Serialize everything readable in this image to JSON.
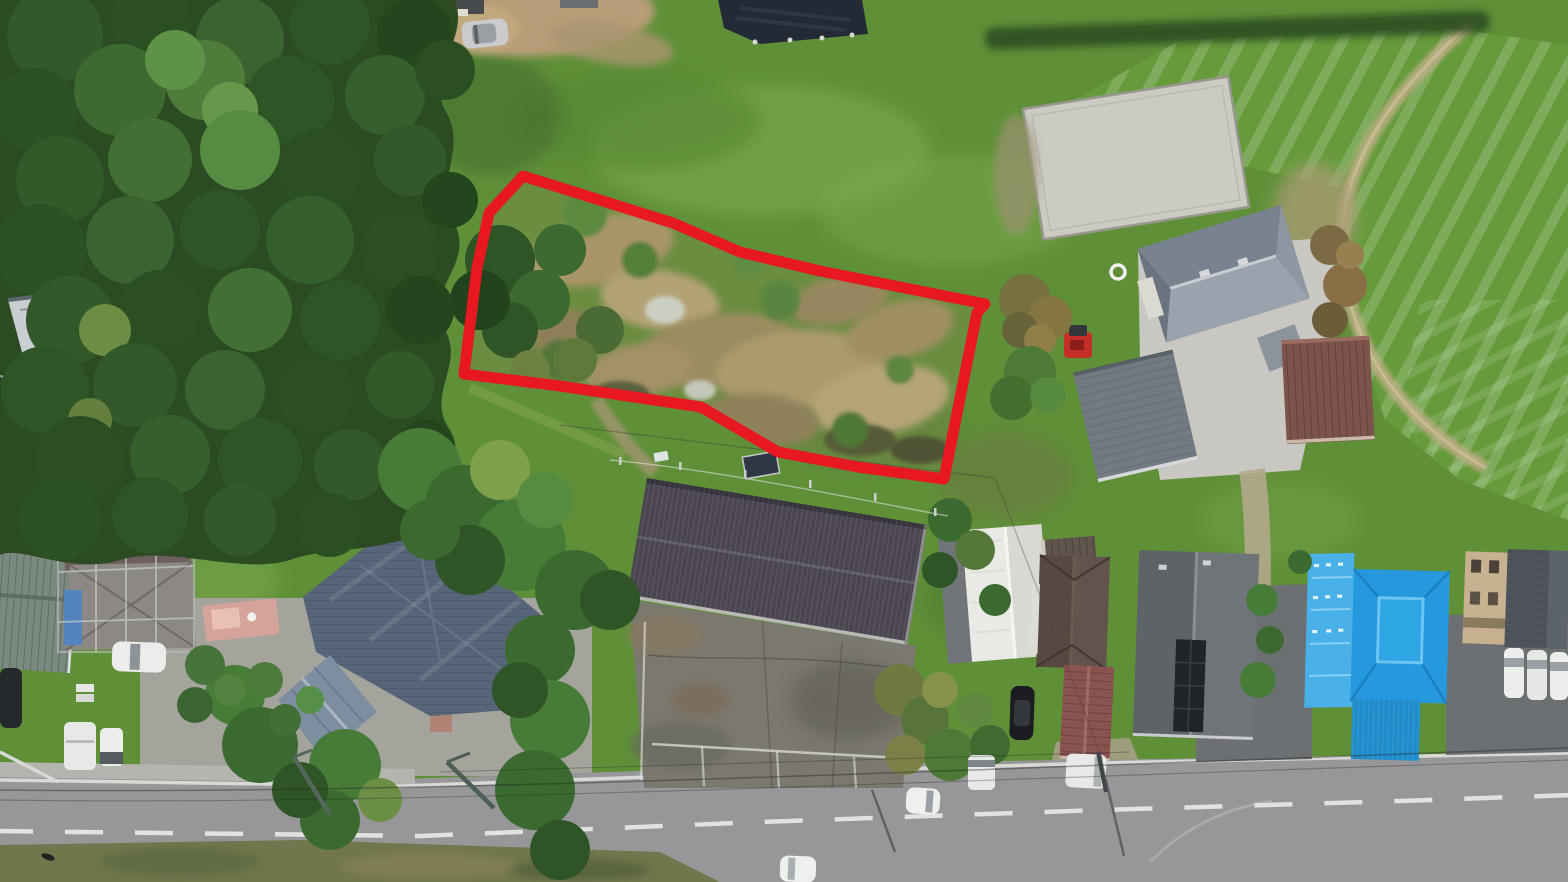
{
  "meta": {
    "type": "aerial-drone-photograph",
    "description": "Overhead drone photo of a rural Japanese roadside neighborhood; a vacant overgrown land parcel is outlined with a thick red boundary annotation.",
    "width_px": 1568,
    "height_px": 882
  },
  "annotation": {
    "name": "property-boundary",
    "shape": "polygon",
    "color": "#e7181f",
    "stroke_width": 11,
    "points_str": "523,176 673,223 740,252 820,271 985,304 977,313 944,479 858,467 778,452 701,407 560,386 464,374 477,268 489,213"
  },
  "palette": {
    "grass": "#5f9038",
    "grass_light": "#7fae53",
    "forest_dark": "#2c4b23",
    "brush_tan": "#a99569",
    "gravel_pad": "#cbcbc4",
    "road_asphalt": "#97979a",
    "parking_asphalt": "#7a786f",
    "warehouse_roof": "#4a4550",
    "slate_blue_roof": "#566579",
    "bright_blue_roof": "#2699de",
    "maroon_roof": "#8a5350",
    "brown_metal_roof": "#7d544c",
    "white_roof": "#e9e9e5",
    "blue_tarp": "#4d84c4",
    "dirt": "#b79c77"
  },
  "scene": {
    "regions": [
      {
        "name": "forest",
        "desc": "dense conifer/broadleaf canopy along left edge",
        "color": "#2c4b23"
      },
      {
        "name": "vacant-parcel-brush",
        "desc": "cleared overgrown lot with dry brown brush inside red boundary",
        "color": "#a99569"
      },
      {
        "name": "striped-field",
        "desc": "mown hay field with curved stripe rows, top right",
        "color": "#659b3b"
      },
      {
        "name": "gravel-pad",
        "desc": "rectangular light gravel pad, upper right",
        "color": "#cbcbc4"
      },
      {
        "name": "black-tarp",
        "desc": "dark weed-control tarp at top center",
        "color": "#232a36"
      },
      {
        "name": "road",
        "desc": "two-lane asphalt road across bottom with white centerline dashes",
        "color": "#97979a"
      },
      {
        "name": "parking-lot",
        "desc": "cracked asphalt lot south of warehouse",
        "color": "#7a786f"
      },
      {
        "name": "dirt-clearing",
        "desc": "bare tan soil clearing at top left",
        "color": "#b79c77"
      }
    ],
    "buildings": [
      {
        "name": "warehouse",
        "roof": "dark corrugated gray",
        "color": "#4a4550"
      },
      {
        "name": "white-roof-building",
        "roof": "white gable",
        "color": "#e9e9e5"
      },
      {
        "name": "renovation-house",
        "roof": "mauve with scaffolding and blue tarps",
        "color": "#6e5e5c"
      },
      {
        "name": "slate-hip-roof-house",
        "roof": "large slate-blue hip roof",
        "color": "#566579"
      },
      {
        "name": "blue-gray-shed",
        "roof": "small light blue-gray gable",
        "color": "#7d8ea0"
      },
      {
        "name": "farmhouse",
        "roof": "gray hip roof, upper right",
        "color": "#79838f"
      },
      {
        "name": "gray-outbuilding",
        "roof": "slate shed roof",
        "color": "#727a84"
      },
      {
        "name": "brown-metal-building",
        "roof": "red-brown standing-seam",
        "color": "#7d544c"
      },
      {
        "name": "dark-brown-house",
        "roof": "dark brown hip",
        "color": "#574842"
      },
      {
        "name": "charcoal-house",
        "roof": "charcoal gable with black solar panel",
        "color": "#5e6368"
      },
      {
        "name": "maroon-shed",
        "roof": "maroon gable",
        "color": "#8a5350"
      },
      {
        "name": "blue-roof-house",
        "roof": "bright blue hip with tarp section",
        "color": "#2699de"
      },
      {
        "name": "tan-building",
        "roof": "tan two-story",
        "color": "#c8b190"
      },
      {
        "name": "corner-dark-roof-house",
        "roof": "dark gray, bottom right corner",
        "color": "#4e545b"
      },
      {
        "name": "forest-shed",
        "roof": "white/gray shed hidden in trees",
        "color": "#c9ced2"
      },
      {
        "name": "green-shed",
        "roof": "olive green shed far left",
        "color": "#6e7848"
      },
      {
        "name": "left-metal-roof-building",
        "roof": "gray-green standing seam, far left",
        "color": "#7b8a80"
      }
    ],
    "vehicles": [
      {
        "name": "silver-hatchback",
        "location": "top-left dirt clearing",
        "color": "#c9cbcd"
      },
      {
        "name": "red-tractor",
        "location": "beside gray outbuilding",
        "color": "#c62f28"
      },
      {
        "name": "white-sedan-lot",
        "location": "left gravel lot",
        "color": "#ecedea"
      },
      {
        "name": "dark-car-left-edge",
        "location": "far left edge",
        "color": "#26292c"
      },
      {
        "name": "white-van-left",
        "location": "left gravel lot, lower",
        "color": "#e8e9e6"
      },
      {
        "name": "white-kei-car-left",
        "location": "left gravel lot, lower",
        "color": "#eceeec"
      },
      {
        "name": "black-suv",
        "location": "beside garden, center right",
        "color": "#1b1d20"
      },
      {
        "name": "white-van-center",
        "location": "north of road at center right",
        "color": "#e8e9e6"
      },
      {
        "name": "white-car-on-road",
        "location": "driving on road",
        "color": "#eef0ee"
      },
      {
        "name": "white-car-road-shoulder",
        "location": "bottom center on road",
        "color": "#eef0ee"
      },
      {
        "name": "white-van-maroon-shed",
        "location": "below maroon shed",
        "color": "#e8e9e6"
      },
      {
        "name": "white-cars-right-driveway",
        "count": 3,
        "location": "bottom right driveway",
        "color": "#eceeec"
      },
      {
        "name": "white-boat-forest",
        "location": "beside forest shed",
        "color": "#f0f0ec"
      }
    ],
    "markers": [
      {
        "name": "white-ring-marker",
        "desc": "small white ring on gravel near farmhouse",
        "color": "#f0f0ec"
      },
      {
        "name": "ground-solar-panel",
        "desc": "small dark panel north of warehouse",
        "color": "#2e3744"
      }
    ]
  }
}
